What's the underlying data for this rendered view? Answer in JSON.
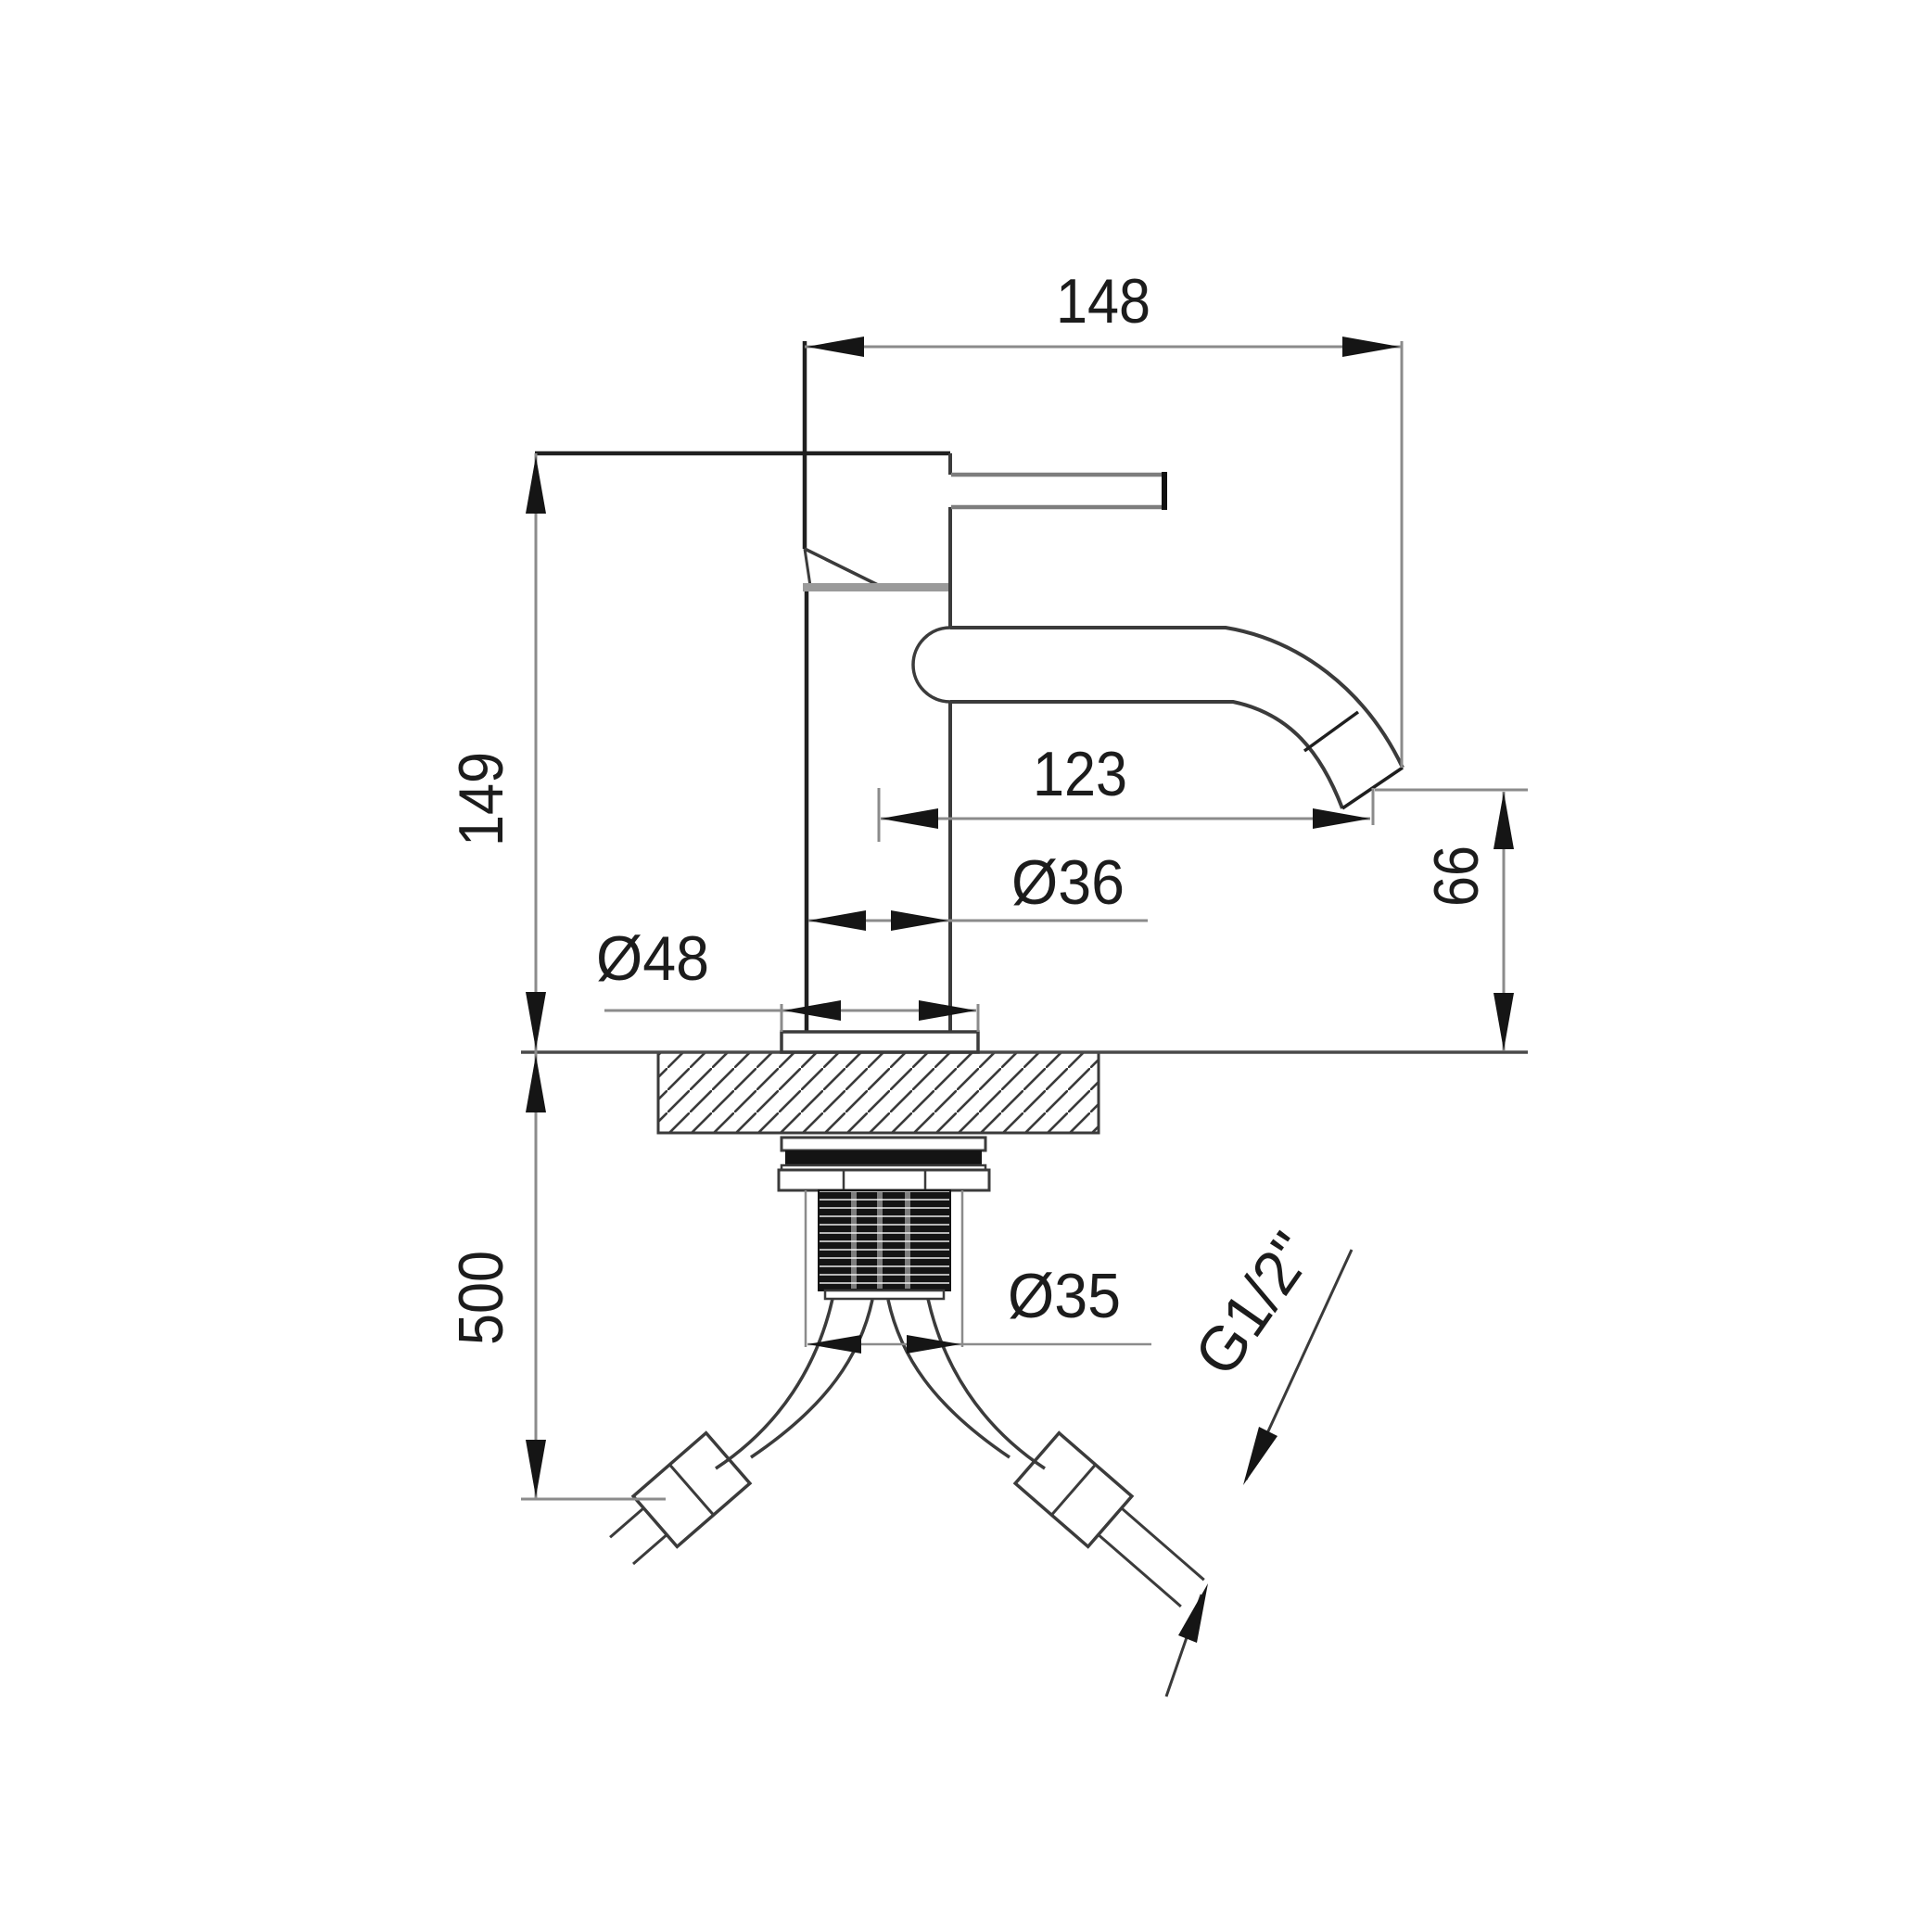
{
  "labels": {
    "overall_width": "148",
    "body_height": "149",
    "spout_reach": "123",
    "body_diameter": "Ø36",
    "base_diameter": "Ø48",
    "spout_outlet_height": "66",
    "supply_hose_length": "500",
    "mounting_hole_diameter": "Ø35",
    "connection_thread": "G1/2\""
  },
  "colors": {
    "background": "#ffffff",
    "outline": "#3b3b3b",
    "dimension_line": "#8b8b8b",
    "arrow": "#151515",
    "label_text": "#1c1c1c",
    "seal_fill": "#141414",
    "collar_fill": "#9a9a9a"
  }
}
